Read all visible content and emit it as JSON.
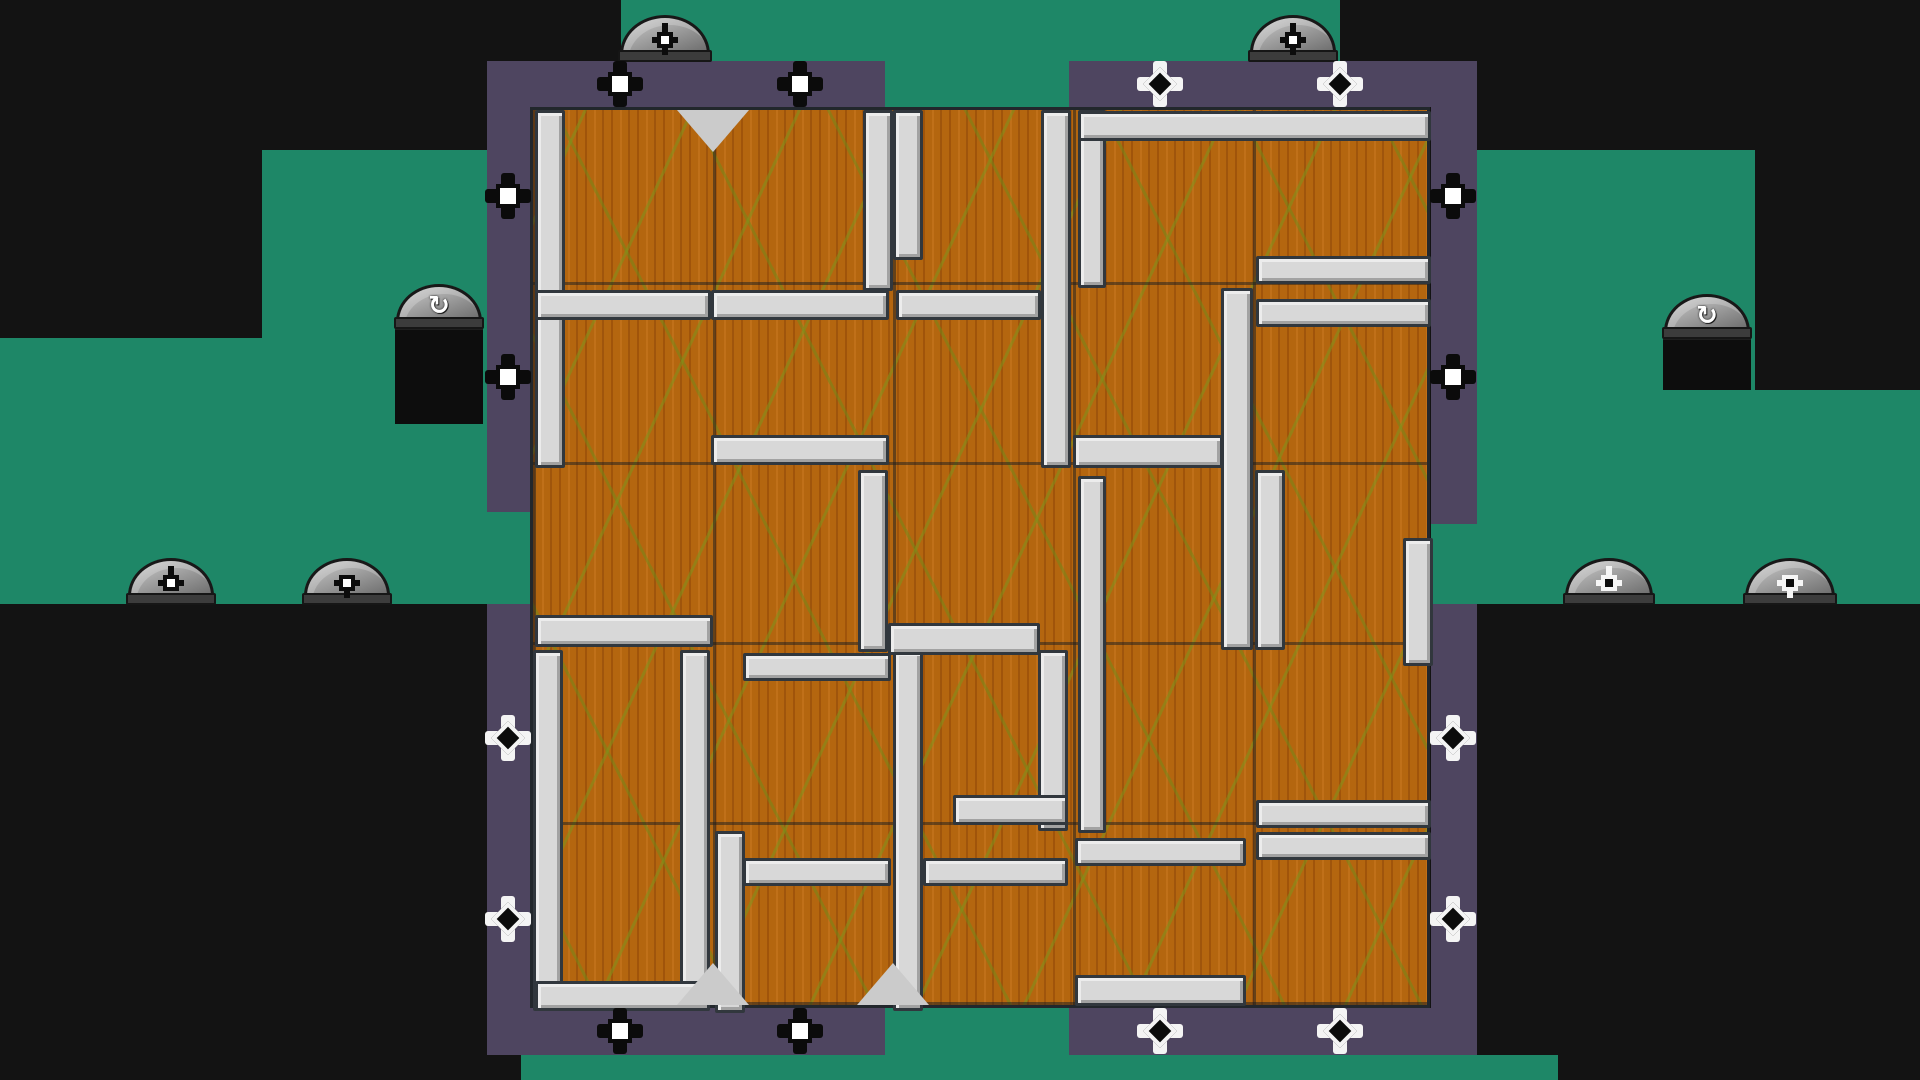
{
  "scene": {
    "width": 1920,
    "height": 1080,
    "background": "#131313"
  },
  "colors": {
    "teal": "#1e8767",
    "purple": "#4e4560",
    "wood": "#b4660f",
    "wood_streak_green": "#7e941c",
    "silver": "#d8d8d8",
    "silver_border": "#31373d",
    "dome_gray": "#909090",
    "black_ground": "#0d0d0d",
    "ghost_blue": "#a6daee",
    "ghost_pupil": "#2f97b4"
  },
  "glyphs": {
    "rotate_cw": "↻"
  },
  "teal_regions": [
    {
      "name": "terrain-teal-left-band",
      "x": 0,
      "y": 338,
      "w": 262,
      "h": 266
    },
    {
      "name": "terrain-teal-upper-left",
      "x": 262,
      "y": 150,
      "w": 225,
      "h": 454
    },
    {
      "name": "terrain-teal-top-strip",
      "x": 621,
      "y": 0,
      "w": 719,
      "h": 61
    },
    {
      "name": "terrain-teal-top-gap",
      "x": 885,
      "y": 61,
      "w": 184,
      "h": 46
    },
    {
      "name": "terrain-teal-right",
      "x": 1477,
      "y": 150,
      "w": 278,
      "h": 454
    },
    {
      "name": "terrain-teal-far-right",
      "x": 1755,
      "y": 390,
      "w": 165,
      "h": 214
    },
    {
      "name": "terrain-teal-bottom-gap",
      "x": 885,
      "y": 1008,
      "w": 184,
      "h": 72
    },
    {
      "name": "terrain-teal-bottom-strip",
      "x": 521,
      "y": 1055,
      "w": 1037,
      "h": 25
    },
    {
      "name": "terrain-teal-frame-gap-left",
      "x": 487,
      "y": 512,
      "w": 43,
      "h": 92
    },
    {
      "name": "terrain-teal-frame-gap-right",
      "x": 1431,
      "y": 524,
      "w": 46,
      "h": 80
    }
  ],
  "frame_panels": [
    {
      "name": "frame-left-column-upper",
      "x": 487,
      "y": 61,
      "w": 43,
      "h": 451
    },
    {
      "name": "frame-left-column-lower",
      "x": 487,
      "y": 604,
      "w": 43,
      "h": 451
    },
    {
      "name": "frame-top-left-bar",
      "x": 487,
      "y": 61,
      "w": 398,
      "h": 46
    },
    {
      "name": "frame-top-right-bar",
      "x": 1069,
      "y": 61,
      "w": 408,
      "h": 46
    },
    {
      "name": "frame-right-column-upper",
      "x": 1431,
      "y": 61,
      "w": 46,
      "h": 463
    },
    {
      "name": "frame-right-column-lower",
      "x": 1431,
      "y": 604,
      "w": 46,
      "h": 451
    },
    {
      "name": "frame-bottom-left-bar",
      "x": 487,
      "y": 1008,
      "w": 398,
      "h": 47
    },
    {
      "name": "frame-bottom-right-bar",
      "x": 1069,
      "y": 1008,
      "w": 408,
      "h": 47
    }
  ],
  "platform_blocks": [
    {
      "name": "platform-block-left",
      "x": 395,
      "y": 328,
      "w": 88,
      "h": 94
    },
    {
      "name": "platform-block-right",
      "x": 1663,
      "y": 338,
      "w": 88,
      "h": 50
    }
  ],
  "maze": {
    "x": 530,
    "y": 107,
    "w": 900,
    "h": 901,
    "cell": 180,
    "bars": [
      [
        2,
        0,
        30,
        358
      ],
      [
        330,
        0,
        30,
        181
      ],
      [
        360,
        0,
        30,
        150
      ],
      [
        508,
        0,
        30,
        358
      ],
      [
        545,
        0,
        28,
        178
      ],
      [
        688,
        178,
        32,
        362
      ],
      [
        545,
        366,
        28,
        357
      ],
      [
        722,
        360,
        30,
        180
      ],
      [
        325,
        360,
        30,
        182
      ],
      [
        0,
        540,
        30,
        361
      ],
      [
        147,
        540,
        30,
        361
      ],
      [
        182,
        721,
        30,
        182
      ],
      [
        360,
        540,
        30,
        361
      ],
      [
        505,
        540,
        30,
        181
      ],
      [
        870,
        428,
        30,
        128
      ],
      [
        545,
        1,
        353,
        30
      ],
      [
        723,
        146,
        175,
        28
      ],
      [
        723,
        189,
        175,
        28
      ],
      [
        2,
        180,
        176,
        30
      ],
      [
        178,
        180,
        178,
        30
      ],
      [
        363,
        180,
        145,
        30
      ],
      [
        178,
        325,
        178,
        30
      ],
      [
        540,
        325,
        150,
        33
      ],
      [
        2,
        505,
        178,
        32
      ],
      [
        355,
        513,
        152,
        32
      ],
      [
        210,
        543,
        148,
        28
      ],
      [
        420,
        685,
        115,
        30
      ],
      [
        723,
        690,
        175,
        28
      ],
      [
        723,
        722,
        175,
        28
      ],
      [
        210,
        748,
        148,
        28
      ],
      [
        390,
        748,
        145,
        28
      ],
      [
        542,
        728,
        171,
        28
      ],
      [
        2,
        871,
        175,
        30
      ],
      [
        542,
        865,
        171,
        31
      ]
    ],
    "notches": [
      {
        "x": 180,
        "edge": "top"
      },
      {
        "x": 180,
        "edge": "bottom"
      },
      {
        "x": 360,
        "edge": "bottom"
      }
    ]
  },
  "domes": [
    {
      "name": "dome-button-top-left",
      "x": 620,
      "y": 15,
      "w": 90,
      "h": 46,
      "icon": "node-pin-icon",
      "variant": "dark",
      "dir": "cross"
    },
    {
      "name": "dome-button-top-right",
      "x": 1250,
      "y": 15,
      "w": 86,
      "h": 46,
      "icon": "node-pin-icon",
      "variant": "dark",
      "dir": "cross"
    },
    {
      "name": "dome-button-rotate-left",
      "x": 396,
      "y": 284,
      "w": 86,
      "h": 44,
      "icon": "rotate-cw-icon",
      "variant": "rotate"
    },
    {
      "name": "dome-button-rotate-right",
      "x": 1664,
      "y": 294,
      "w": 86,
      "h": 44,
      "icon": "rotate-cw-icon",
      "variant": "rotate"
    },
    {
      "name": "dome-button-pin-up-left",
      "x": 128,
      "y": 558,
      "w": 86,
      "h": 46,
      "icon": "node-pin-icon",
      "variant": "dark",
      "dir": "up"
    },
    {
      "name": "dome-button-pin-down-left",
      "x": 304,
      "y": 558,
      "w": 86,
      "h": 46,
      "icon": "node-pin-icon",
      "variant": "dark",
      "dir": "down"
    },
    {
      "name": "dome-button-pin-up-right",
      "x": 1565,
      "y": 558,
      "w": 88,
      "h": 46,
      "icon": "node-pin-icon",
      "variant": "light",
      "dir": "up"
    },
    {
      "name": "dome-button-pin-down-right",
      "x": 1745,
      "y": 558,
      "w": 90,
      "h": 46,
      "icon": "node-pin-icon",
      "variant": "light",
      "dir": "down"
    }
  ],
  "nodes": [
    {
      "name": "connector-node-top-1",
      "x": 620,
      "y": 84,
      "variant": "dark"
    },
    {
      "name": "connector-node-top-2",
      "x": 800,
      "y": 84,
      "variant": "dark"
    },
    {
      "name": "connector-node-top-3",
      "x": 1160,
      "y": 84,
      "variant": "light"
    },
    {
      "name": "connector-node-top-4",
      "x": 1340,
      "y": 84,
      "variant": "light"
    },
    {
      "name": "connector-node-left-1",
      "x": 508,
      "y": 196,
      "variant": "dark"
    },
    {
      "name": "connector-node-left-2",
      "x": 508,
      "y": 377,
      "variant": "dark"
    },
    {
      "name": "connector-node-left-3",
      "x": 508,
      "y": 738,
      "variant": "light"
    },
    {
      "name": "connector-node-left-4",
      "x": 508,
      "y": 919,
      "variant": "light"
    },
    {
      "name": "connector-node-right-1",
      "x": 1453,
      "y": 196,
      "variant": "dark"
    },
    {
      "name": "connector-node-right-2",
      "x": 1453,
      "y": 377,
      "variant": "dark"
    },
    {
      "name": "connector-node-right-3",
      "x": 1453,
      "y": 738,
      "variant": "light"
    },
    {
      "name": "connector-node-right-4",
      "x": 1453,
      "y": 919,
      "variant": "light"
    },
    {
      "name": "connector-node-bottom-1",
      "x": 620,
      "y": 1031,
      "variant": "dark"
    },
    {
      "name": "connector-node-bottom-2",
      "x": 800,
      "y": 1031,
      "variant": "dark"
    },
    {
      "name": "connector-node-bottom-3",
      "x": 1160,
      "y": 1031,
      "variant": "light"
    },
    {
      "name": "connector-node-bottom-4",
      "x": 1340,
      "y": 1031,
      "variant": "light"
    }
  ],
  "ghost": {
    "x": 390,
    "y": 470,
    "w": 124,
    "h": 134
  }
}
